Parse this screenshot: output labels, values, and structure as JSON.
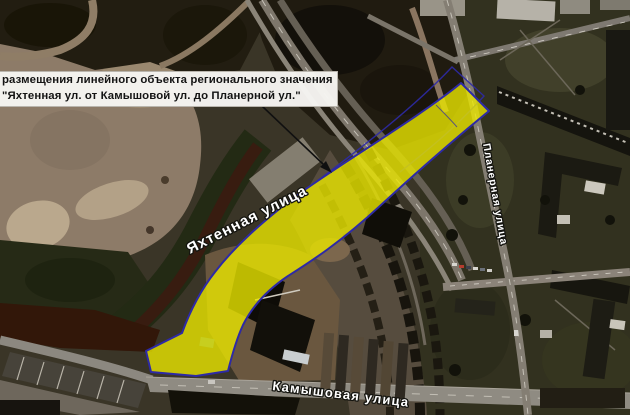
{
  "annotation": {
    "line1": "размещения линейного объекта регионального значения",
    "line2": "\"Яхтенная ул. от Камышовой ул. до Планерной ул.\""
  },
  "streets": {
    "yakhtennaya": "Яхтенная улица",
    "planernaya": "Планерная улица",
    "kamyshovaya": "Камышовая улица"
  },
  "overlay": {
    "zone_fill": "#EAE600",
    "zone_border": "#2D2AA6",
    "annotation_bg": "#F6F5F2",
    "annotation_text": "#141414",
    "street_label_color": "#FFFFFF"
  }
}
